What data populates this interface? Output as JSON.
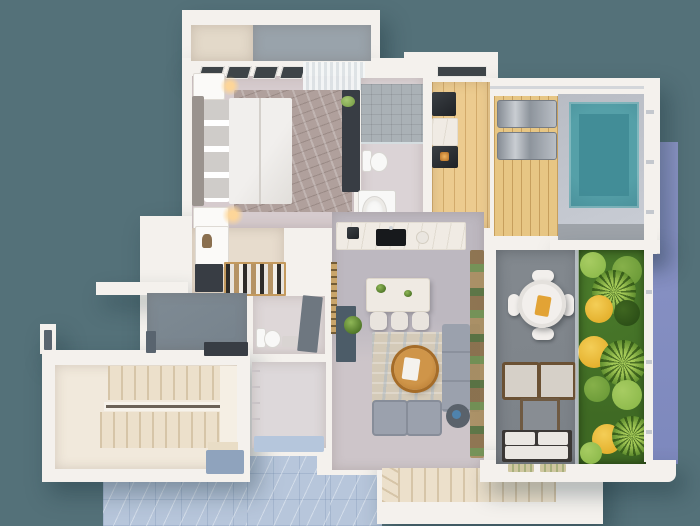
{
  "type": "3d-floor-plan-render",
  "description": "Top-down 3D render of an apartment floor plan with pool terrace and vertical garden. No visible text in the image.",
  "colors": {
    "bg": "#547179",
    "periwinkle": "#8c95c6",
    "periwinkle-dark": "#7d88bd",
    "wall": "#f4f1ed",
    "balcony-cream": "#e3d9c9",
    "balcony-floor": "#99a3ab",
    "bedroom-floor": "#d6cbce",
    "bedroom-rug": "#b0a09c",
    "headboard": "#9a938e",
    "pillow": "#cfccc9",
    "bath-floor": "#dbd3d6",
    "shower-tile": "#aab1b6",
    "fixture-white": "#f8f8f7",
    "wood-floor": "#eccb8f",
    "deck": "#e7c684",
    "pool-surround": "#b8bcc4",
    "pool-water": "#55a0a8",
    "pool-deep": "#3f8a94",
    "terrace-floor": "#7b8187",
    "outdoor-table": "#f2efec",
    "outdoor-cushion": "#d6d0c8",
    "rattan": "#6b5134",
    "outdoor-sofa-cushion": "#eae7e2",
    "outdoor-frame": "#3b3835",
    "closet-floor": "#e7dccd",
    "hall-floor": "#76828c",
    "powder-floor": "#ded7d8",
    "alcove-floor": "#ddd8da",
    "alcove-mat": "#b5c6dc",
    "kitchen-floor": "#bdb8c0",
    "living-floor": "#cdc5c9",
    "counter": "#f0ebe4",
    "island": "#efeae3",
    "stool": "#e9e4de",
    "peg-strip": "#c9a56a",
    "teal-cabinet": "#4c5c68",
    "rug-living": "#d4cab8",
    "coffee-wood": "#bd8036",
    "sofa-gray": "#9ba1ad",
    "sofa-dark": "#878d99",
    "side-table": "#5a626b",
    "garden-base": "#3f6a24",
    "garden-g1": "#6d9c39",
    "garden-g2": "#8fbb4d",
    "garden-dark": "#2c4f17",
    "garden-yellow": "#e5b22f",
    "stair-floor": "#f1e9dc",
    "stair-tread": "#ece0cb",
    "stair-line": "#d6c5a8",
    "blue-floor": "#b7c6db",
    "door-gray": "#6e7780",
    "console-dark": "#383d44",
    "window-dark": "#3e4448",
    "wardrobe-wood": "#c49a5e"
  },
  "rooms": [
    {
      "name": "balcony",
      "items": [
        "parapet",
        "balcony-floor"
      ]
    },
    {
      "name": "master-bedroom",
      "items": [
        "windows",
        "curtains",
        "double-bed",
        "headboard",
        "pillows",
        "duvet",
        "nightstands",
        "table-lamps",
        "area-rug",
        "desk-console",
        "green-chair"
      ]
    },
    {
      "name": "master-bathroom",
      "items": [
        "shower",
        "toilet",
        "sink-counter"
      ]
    },
    {
      "name": "kitchenette-nook",
      "items": [
        "clerestory-window",
        "coffee-station",
        "marble-cabinet",
        "oven"
      ]
    },
    {
      "name": "pool-terrace",
      "items": [
        "wood-deck",
        "sun-lounger",
        "sun-lounger",
        "swimming-pool",
        "pool-surround",
        "railing",
        "pergola-slab"
      ]
    },
    {
      "name": "walk-in-closet",
      "items": [
        "shelf-unit",
        "dresser",
        "wardrobe-rail-with-clothes"
      ]
    },
    {
      "name": "entry-hall",
      "items": [
        "console-table",
        "entry-door"
      ]
    },
    {
      "name": "powder-room",
      "items": [
        "toilet",
        "washbasin",
        "door"
      ]
    },
    {
      "name": "storage-alcove",
      "items": [
        "wall-shelves",
        "floor-mat"
      ]
    },
    {
      "name": "kitchen",
      "items": [
        "counter-with-hob-and-sink",
        "pegboard-strip",
        "tall-teal-cabinet",
        "potted-plant",
        "island-dining-table",
        "stools"
      ]
    },
    {
      "name": "living-room",
      "items": [
        "area-rug",
        "round-wood-coffee-table",
        "sectional-sofa",
        "armchairs",
        "side-table-with-vase",
        "dried-plant-shelf"
      ]
    },
    {
      "name": "main-staircase",
      "items": [
        "upper-flight",
        "handrail",
        "lower-flight",
        "landing"
      ]
    },
    {
      "name": "lower-staircase",
      "items": [
        "winder-steps",
        "straight-run",
        "landing"
      ]
    },
    {
      "name": "outdoor-terrace",
      "items": [
        "round-dining-table",
        "terrace-chairs",
        "serving-tray",
        "outdoor-armchairs",
        "outdoor-coffee-table",
        "outdoor-sofa",
        "door-mats"
      ]
    },
    {
      "name": "vertical-garden",
      "items": [
        "planting-bed",
        "palms",
        "shrubs",
        "yellow-flower-clusters",
        "glass-railing"
      ]
    },
    {
      "name": "lower-level-floor",
      "items": [
        "blue-marble-tiles"
      ]
    }
  ]
}
